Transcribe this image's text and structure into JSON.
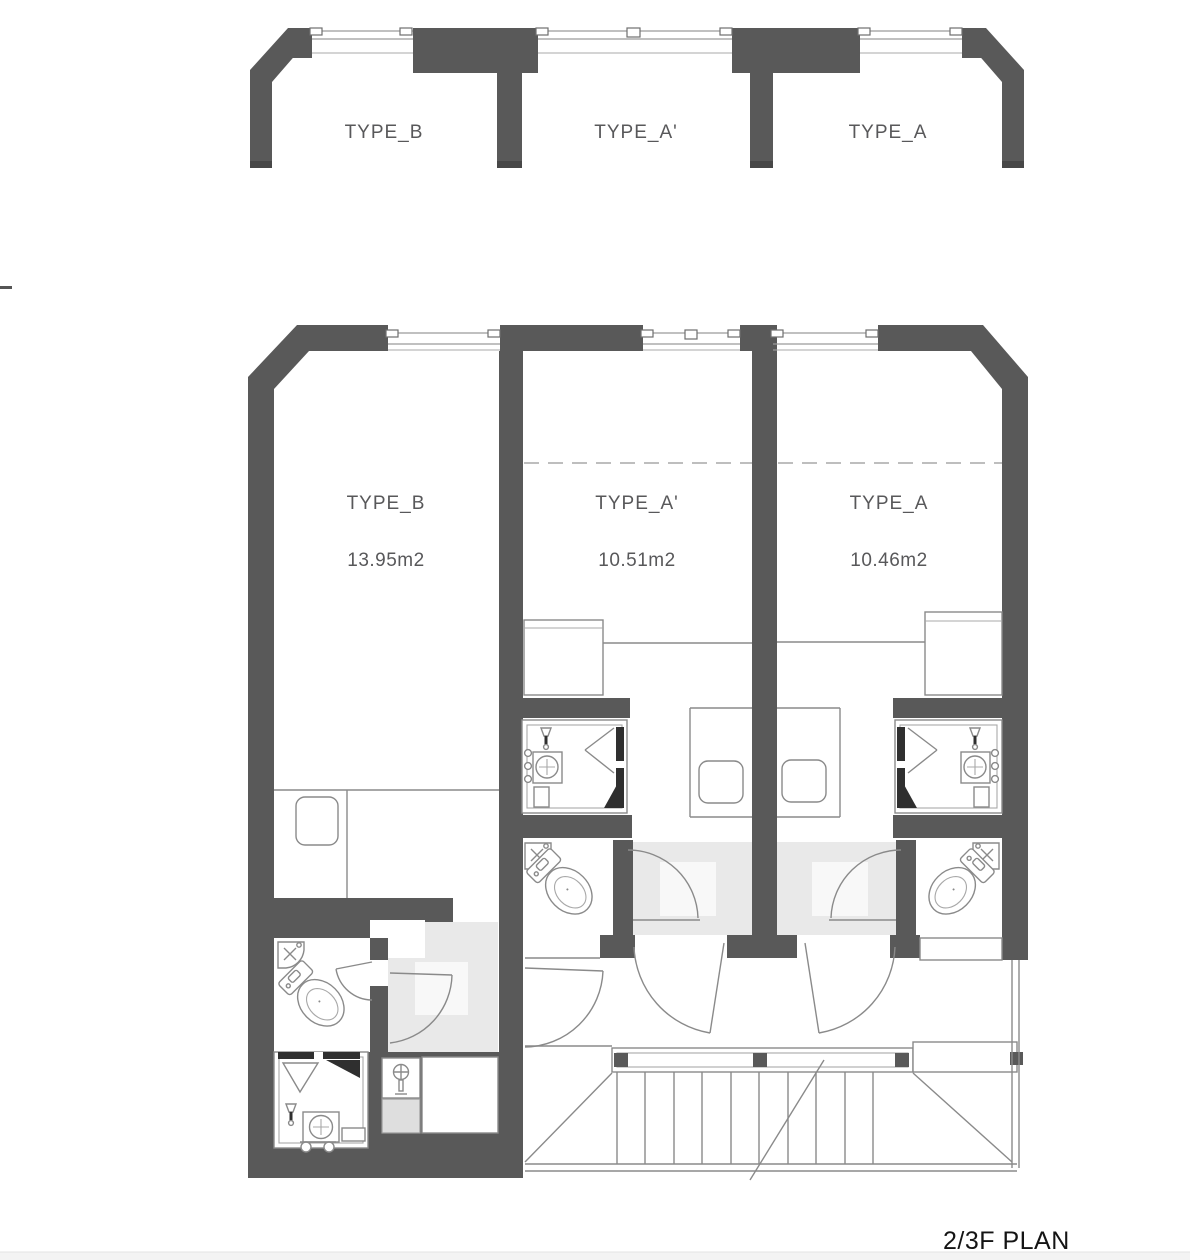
{
  "title": {
    "label": "2/3F PLAN"
  },
  "upper_plan": {
    "description": "partial plan strip",
    "rooms": [
      {
        "label": "TYPE_B"
      },
      {
        "label": "TYPE_A'"
      },
      {
        "label": "TYPE_A"
      }
    ]
  },
  "main_plan": {
    "rooms": [
      {
        "label": "TYPE_B",
        "area": "13.95m2"
      },
      {
        "label": "TYPE_A'",
        "area": "10.51m2"
      },
      {
        "label": "TYPE_A",
        "area": "10.46m2"
      }
    ]
  },
  "icons": [
    "toilet-icon",
    "corner-sink-icon",
    "shower-head-icon",
    "faucet-icon",
    "wash-basin-icon",
    "sliding-door-icon",
    "door-swing-icon",
    "stair-icon",
    "stool-icon"
  ],
  "colors": {
    "wall": "#595959",
    "entry_shade": "#e9e9e9",
    "fixture_line": "#8a8a8a",
    "title_text": "#141414",
    "label_text": "#58585a"
  }
}
